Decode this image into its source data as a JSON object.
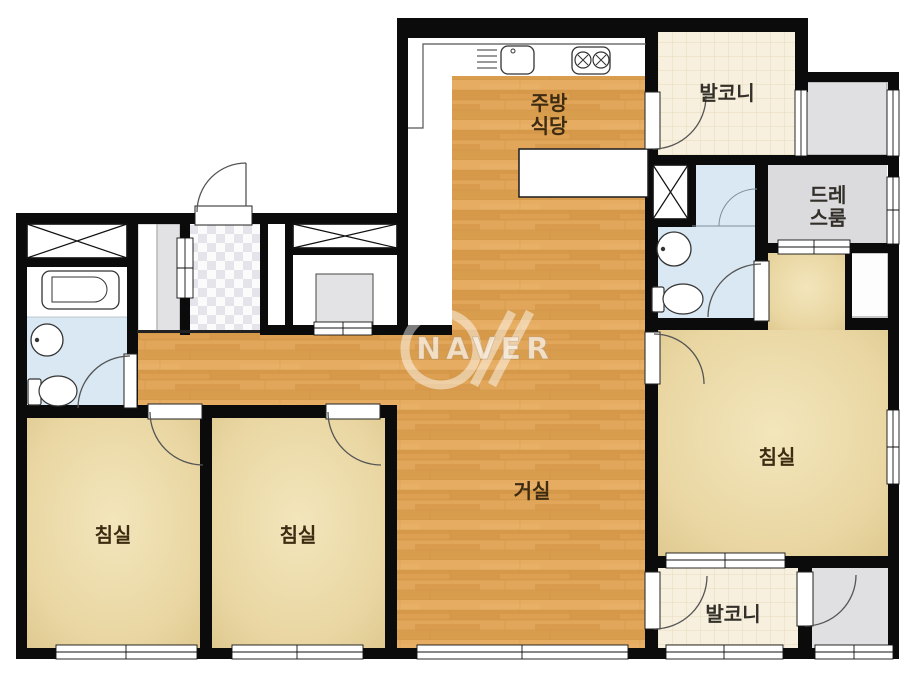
{
  "plan": {
    "watermark": {
      "text": "NAVER"
    },
    "rooms": {
      "kitchen": {
        "l1": "주방",
        "l2": "식당"
      },
      "balcony_top": {
        "label": "발코니"
      },
      "dressroom": {
        "l1": "드레",
        "l2": "스룸"
      },
      "bedroom_master": {
        "label": "침실"
      },
      "living": {
        "label": "거실"
      },
      "bedroom_1": {
        "label": "침실"
      },
      "bedroom_2": {
        "label": "침실"
      },
      "balcony_bottom": {
        "label": "발코니"
      }
    },
    "colors": {
      "wall": "#0b0b0b",
      "wood_floor": "#dea157",
      "bedroom_floor": "#ecd9a6",
      "balcony_tile": "#f8f0df",
      "bathroom_blue": "#d9e8f2",
      "utility_gray": "#dcdcde",
      "label_text": "#3d2c12"
    }
  }
}
